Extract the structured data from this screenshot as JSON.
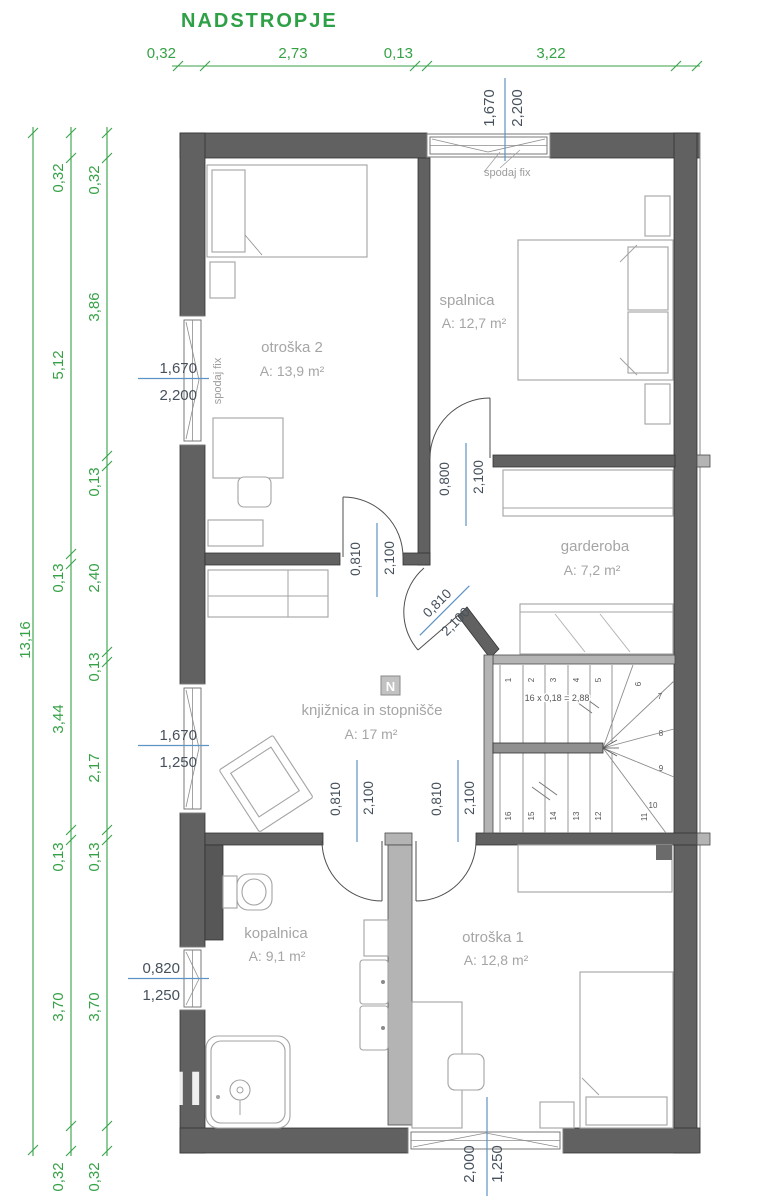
{
  "title": "NADSTROPJE",
  "colors": {
    "dim_green": "#36a246",
    "dim_blue": "#5e93c5",
    "dim_text": "#46515d",
    "room_label": "#a5a5a5",
    "wall_dark": "#616161",
    "wall_light": "#b4b4b4"
  },
  "dims": {
    "top": [
      "0,32",
      "2,73",
      "0,13",
      "3,22"
    ],
    "left_total": "13,16",
    "left_mid": [
      "0,32",
      "5,12",
      "0,13",
      "3,44",
      "0,13",
      "3,70",
      "0,32"
    ],
    "left_inner": [
      "0,32",
      "3,86",
      "0,13",
      "2,40",
      "0,13",
      "2,17",
      "0,13",
      "3,70",
      "0,32"
    ]
  },
  "windows": {
    "top": {
      "w": "1,670",
      "h": "2,200",
      "note": "spodaj fix"
    },
    "left_upper": {
      "w": "1,670",
      "h": "2,200",
      "note": "spodaj fix"
    },
    "left_mid": {
      "w": "1,670",
      "h": "1,250"
    },
    "left_lower": {
      "w": "0,820",
      "h": "1,250"
    },
    "bottom": {
      "w": "2,000",
      "h": "1,250"
    }
  },
  "doors": {
    "spalnica": {
      "w": "0,800",
      "h": "2,100"
    },
    "otroska2": {
      "w": "0,810",
      "h": "2,100"
    },
    "garderoba": {
      "w": "0,810",
      "h": "2,100"
    },
    "kopalnica": {
      "w": "0,810",
      "h": "2,100"
    },
    "otroska1": {
      "w": "0,810",
      "h": "2,100"
    }
  },
  "rooms": {
    "otroska2": {
      "name": "otroška 2",
      "area": "A: 13,9 m²"
    },
    "spalnica": {
      "name": "spalnica",
      "area": "A: 12,7 m²"
    },
    "garderoba": {
      "name": "garderoba",
      "area": "A: 7,2 m²"
    },
    "knjiznica": {
      "name": "knjižnica in stopnišče",
      "area": "A: 17 m²"
    },
    "kopalnica": {
      "name": "kopalnica",
      "area": "A: 9,1 m²"
    },
    "otroska1": {
      "name": "otroška 1",
      "area": "A: 12,8 m²"
    }
  },
  "stairs": {
    "formula": "16 x 0,18 = 2,88",
    "steps": [
      "1",
      "2",
      "3",
      "4",
      "5",
      "6",
      "7",
      "8",
      "9",
      "10",
      "11",
      "12",
      "13",
      "14",
      "15",
      "16"
    ]
  },
  "north": "N",
  "watermark": "MI"
}
